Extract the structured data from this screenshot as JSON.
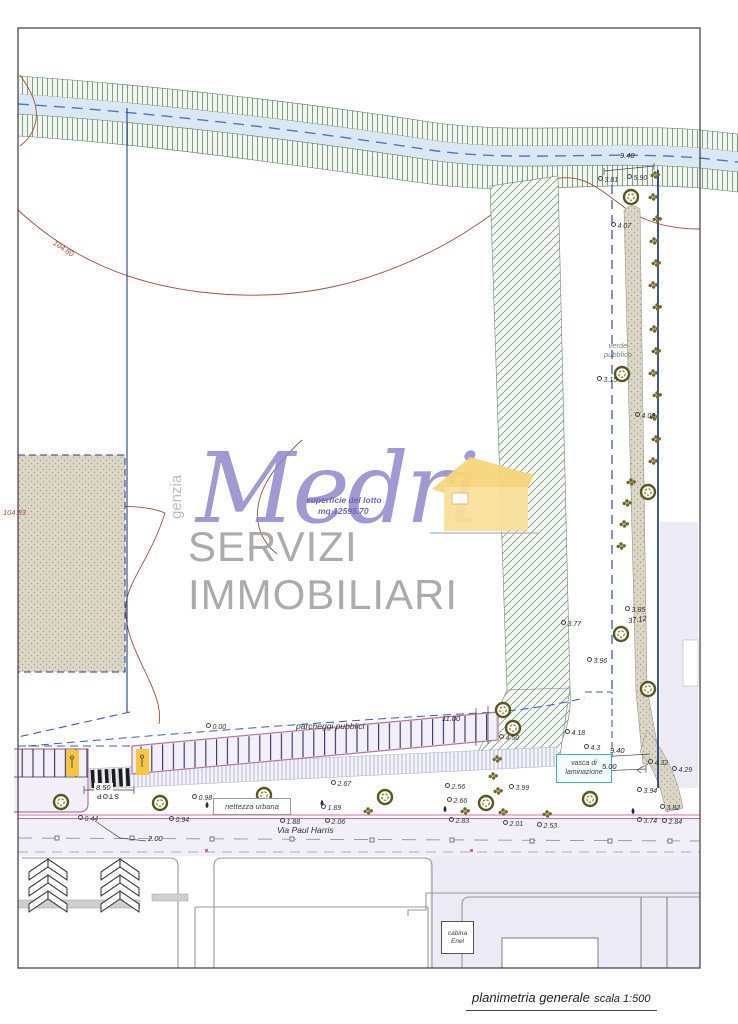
{
  "colors": {
    "brand_purple": "#8b85c7",
    "subtitle_gray": "#a2a2a6",
    "house_yellow": "#f8d982",
    "water_blue": "#dbe8f4",
    "contour_red": "#a0503c",
    "boundary_blue": "#3a5bbf",
    "parking_outline_pink": "#b07898",
    "street_curb_pink": "#cf6f9f",
    "vasca_teal": "#3fb3ba",
    "stall_yellow": "#f5c63e"
  },
  "watermark": {
    "brand": "Medri",
    "subtitle": "SERVIZI IMMOBILIARI",
    "vertical_text": "genzia"
  },
  "caption": {
    "title": "planimetria generale",
    "scale": "scala 1:500"
  },
  "lot": {
    "surface_label": "superficie del lotto",
    "surface_value": "mq 12595.70"
  },
  "labels": {
    "parcheggi": "parcheggi pubblici",
    "verde_line1": "verde",
    "verde_line2": "pubblico",
    "vasca_line1": "vasca di",
    "vasca_line2": "laminazione",
    "nettezza": "nettezza urbana",
    "via": "Via Paul Harris",
    "stop": "STOP",
    "cabina_line1": "cabina",
    "cabina_line2": "Enel"
  },
  "contours": [
    "104.80",
    "104.83"
  ],
  "dimensions": {
    "canal_embankment": "9.40",
    "green_strip_length": "37.12",
    "parking_depth": "11.00",
    "crossing_width": "8.50",
    "road_half": "2.00",
    "basin_side": "5.00",
    "basin_front": "9.40"
  },
  "spots": [
    "3.81",
    "5.90",
    "4.07",
    "3.15",
    "4.09",
    "3.85",
    "3.77",
    "3.96",
    "4.18",
    "4.3",
    "4.50",
    "0.00",
    "2.67",
    "0.98",
    "0.44",
    "0.94",
    "1.88",
    "2.06",
    "1.89",
    "2.56",
    "3.99",
    "2.66",
    "2.83",
    "2.01",
    "2.53",
    "3.94",
    "3.82",
    "3.74",
    "2.84",
    "4.32",
    "4.29"
  ]
}
